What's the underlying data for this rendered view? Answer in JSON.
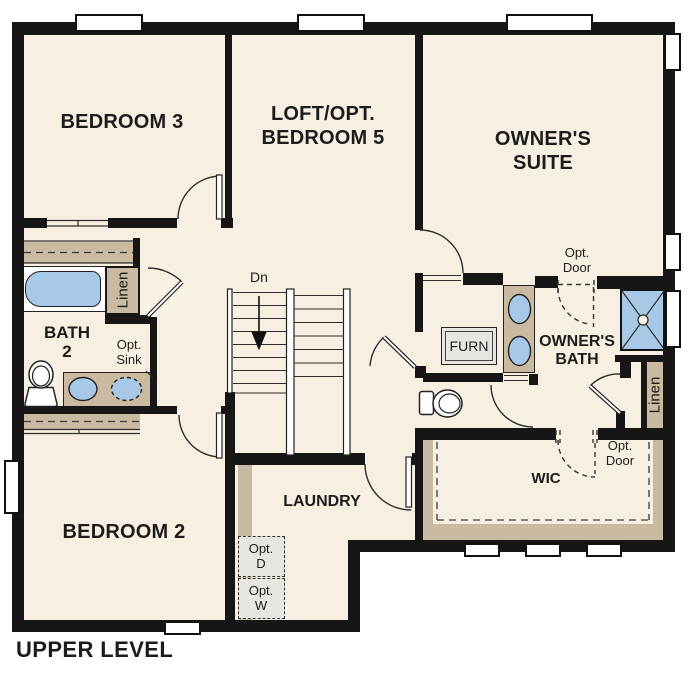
{
  "title": "UPPER LEVEL",
  "rooms": {
    "bedroom3": "BEDROOM 3",
    "loft_line1": "LOFT/OPT.",
    "loft_line2": "BEDROOM 5",
    "owners_suite_line1": "OWNER'S",
    "owners_suite_line2": "SUITE",
    "bath2_line1": "BATH",
    "bath2_line2": "2",
    "bedroom2": "BEDROOM 2",
    "laundry": "LAUNDRY",
    "owners_bath_line1": "OWNER'S",
    "owners_bath_line2": "BATH",
    "wic": "WIC",
    "furnace": "FURN"
  },
  "annotations": {
    "stairs_direction": "Dn",
    "optional_sink_line1": "Opt.",
    "optional_sink_line2": "Sink",
    "optional_door_line1": "Opt.",
    "optional_door_line2": "Door",
    "optional_dryer_line1": "Opt.",
    "optional_dryer_line2": "D",
    "optional_washer_line1": "Opt.",
    "optional_washer_line2": "W",
    "linen_hall": "Linen",
    "linen_owner": "Linen"
  },
  "colors": {
    "wall": "#161616",
    "floor": "#f7efe2",
    "closet": "#c9baa1",
    "fixture_blue": "#a7c8e7",
    "appliance_gray": "#e7e6e1",
    "outline": "#2e2e2e",
    "text": "#1c1c1c",
    "background": "#ffffff"
  }
}
